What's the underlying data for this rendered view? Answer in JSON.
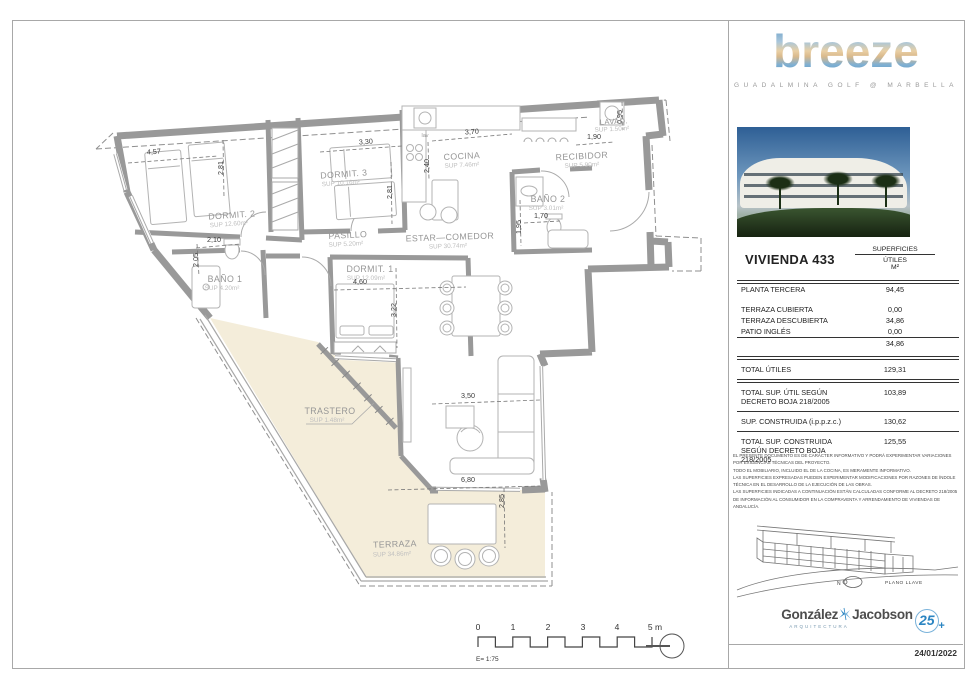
{
  "brand": {
    "name": "breeze",
    "tagline": "GUADALMINA GOLF @ MARBELLA"
  },
  "unit": {
    "title": "VIVIENDA 433"
  },
  "table": {
    "header": {
      "col1": "SUPERFICIES",
      "col2": "ÚTILES",
      "col3": "M²"
    },
    "rows": {
      "planta": {
        "label": "PLANTA TERCERA",
        "value": "94,45"
      },
      "terraza_cubierta": {
        "label": "TERRAZA CUBIERTA",
        "value": "0,00"
      },
      "terraza_descubierta": {
        "label": "TERRAZA DESCUBIERTA",
        "value": "34,86"
      },
      "patio_ingles": {
        "label": "PATIO INGLÉS",
        "value": "0,00"
      },
      "subtotal": {
        "label": "",
        "value": "34,86"
      },
      "total_utiles": {
        "label": "TOTAL ÚTILES",
        "value": "129,31"
      },
      "total_util_decreto": {
        "label": "TOTAL SUP. ÚTIL SEGÚN DECRETO BOJA 218/2005",
        "value": "103,89"
      },
      "construida": {
        "label": "SUP. CONSTRUIDA (i.p.p.z.c.)",
        "value": "130,62"
      },
      "total_construida_decreto": {
        "label": "TOTAL SUP. CONSTRUIDA SEGÚN DECRETO BOJA 218/2005",
        "value": "125,55"
      }
    }
  },
  "legal": {
    "lines": [
      "EL PRESENTE DOCUMENTO ES DE CARÁCTER INFORMATIVO Y PODRÁ EXPERIMENTAR VARIACIONES POR EXIGENCIAS TÉCNICAS DEL PROYECTO.",
      "TODO EL MOBILIARIO, INCLUIDO EL DE LA COCINA, ES MERAMENTE INFORMATIVO.",
      "LAS SUPERFICIES EXPRESADAS PUEDEN EXPERIMENTAR MODIFICACIONES POR RAZONES DE ÍNDOLE TÉCNICA EN EL DESARROLLO DE LA EJECUCIÓN DE LAS OBRAS.",
      "LAS SUPERFICIES INDICADAS A CONTINUACIÓN ESTÁN CALCULADAS CONFORME AL DECRETO 218/2005 DE INFORMACIÓN AL CONSUMIDOR EN LA COMPRAVENTA Y ARRENDAMIENTO DE VIVIENDAS DE ANDALUCÍA."
    ]
  },
  "keyplan": {
    "north": "N",
    "label": "PLANO LLAVE"
  },
  "footer": {
    "firm_first": "González",
    "firm_second": "Jacobson",
    "firm_sub": "ARQUITECTURA",
    "anniversary": "25",
    "anniversary_plus": "+",
    "date": "24/01/2022"
  },
  "plan": {
    "rooms": {
      "dormit2": {
        "name": "DORMIT. 2",
        "sup": "SUP 12.60m²"
      },
      "dormit3": {
        "name": "DORMIT. 3",
        "sup": "SUP 10.16m²"
      },
      "cocina": {
        "name": "COCINA",
        "sup": "SUP 7.46m²"
      },
      "recibidor": {
        "name": "RECIBIDOR",
        "sup": "SUP 5.90m²"
      },
      "lavadero": {
        "name": "LAVAD.",
        "sup": "SUP 1.50m²"
      },
      "bano2": {
        "name": "BAÑO 2",
        "sup": "SUP 3.01m²"
      },
      "pasillo": {
        "name": "PASILLO",
        "sup": "SUP 5.20m²"
      },
      "estar": {
        "name": "ESTAR—COMEDOR",
        "sup": "SUP 30.74m²"
      },
      "dormit1": {
        "name": "DORMIT. 1",
        "sup": "SUP 12.09m²"
      },
      "bano1": {
        "name": "BAÑO 1",
        "sup": "SUP 4.20m²"
      },
      "trastero": {
        "name": "TRASTERO",
        "sup": "SUP 1.48m²"
      },
      "terraza": {
        "name": "TERRAZA",
        "sup": "SUP 34.86m²"
      }
    },
    "dims": {
      "d457": "4,57",
      "d281a": "2,81",
      "d330": "3,30",
      "d281b": "2,81",
      "d370": "3,70",
      "d240": "2,40",
      "d190": "1,90",
      "d095": "0,95",
      "d170": "1,70",
      "d195": "1,95",
      "d210": "2,10",
      "d205": "2,05",
      "d460": "4,60",
      "d322": "3,22",
      "d350": "3,50",
      "d680": "6,80",
      "d285": "2,85"
    },
    "misc": {
      "lav": "lav"
    }
  },
  "scalebar": {
    "t0": "0",
    "t1": "1",
    "t2": "2",
    "t3": "3",
    "t4": "4",
    "t5": "5 m",
    "scale": "E= 1:75"
  }
}
